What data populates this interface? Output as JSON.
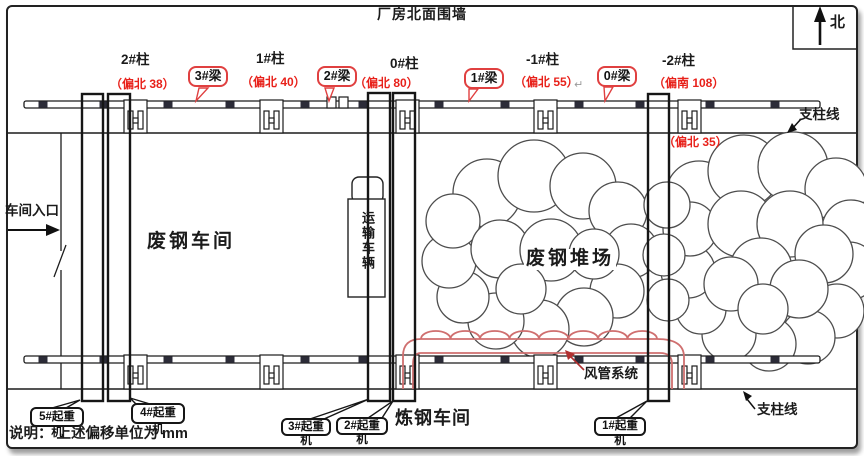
{
  "colors": {
    "line": "#1c1c1c",
    "red_text": "#e8211a",
    "bubble_border": "#e04040",
    "duct_red": "#cf6f6f",
    "rail_marker": "#2c2c38"
  },
  "header": {
    "north_wall_label": "厂房北面围墙",
    "north_label": "北"
  },
  "columns": [
    {
      "label": "2#柱",
      "offset": "（偏北 38）"
    },
    {
      "label": "1#柱",
      "offset": "（偏北 40）"
    },
    {
      "label": "0#柱",
      "offset": "（偏北 80）"
    },
    {
      "label": "-1#柱",
      "offset": "（偏北 55）"
    },
    {
      "label": "-2#柱",
      "offset": "（偏南 108）"
    }
  ],
  "beams": [
    {
      "label": "3#梁"
    },
    {
      "label": "2#梁"
    },
    {
      "label": "1#梁"
    },
    {
      "label": "0#梁"
    }
  ],
  "support_lines": {
    "top_label": "支柱线",
    "bottom_label": "支柱线",
    "bottom_right_offset": "（偏北 35）"
  },
  "entrance": {
    "label": "车间入口"
  },
  "areas": {
    "scrap_workshop": "废钢车间",
    "transport_vehicle": "运输车辆",
    "scrap_yard": "废钢堆场",
    "duct_system": "风管系统",
    "steel_workshop": "炼钢车间"
  },
  "cranes": [
    {
      "label": "5#起重机"
    },
    {
      "label": "4#起重机"
    },
    {
      "label": "3#起重机"
    },
    {
      "label": "2#起重机"
    },
    {
      "label": "1#起重机"
    }
  ],
  "note": "说明： 上述偏移单位为 mm",
  "misc": {
    "return_mark": "↵"
  }
}
